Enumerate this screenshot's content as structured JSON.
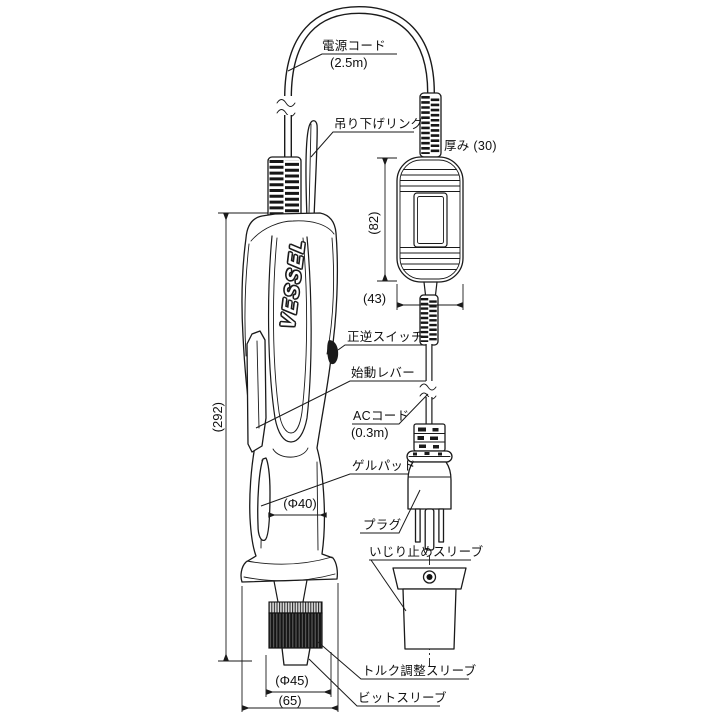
{
  "drawing": {
    "brand": "VESSEL",
    "labels": {
      "power_cord": "電源コード",
      "power_cord_length": "(2.5m)",
      "hanging_ring": "吊り下げリング",
      "thickness": "厚み (30)",
      "forward_reverse_switch": "正逆スイッチ",
      "start_lever": "始動レバー",
      "ac_cord": "ACコード",
      "ac_cord_length": "(0.3m)",
      "gel_pad": "ゲルパッド",
      "plug": "プラグ",
      "tamper_proof_sleeve": "いじり止めスリーブ",
      "torque_adjust_sleeve": "トルク調整スリーブ",
      "bit_sleeve": "ビットスリーブ"
    },
    "dimensions": {
      "overall_length": "(292)",
      "controller_height": "(82)",
      "controller_width": "(43)",
      "grip_diameter": "(Φ40)",
      "sleeve_diameter": "(Φ45)",
      "base_width": "(65)"
    },
    "colors": {
      "line": "#1a1a1a",
      "background": "#ffffff"
    }
  }
}
